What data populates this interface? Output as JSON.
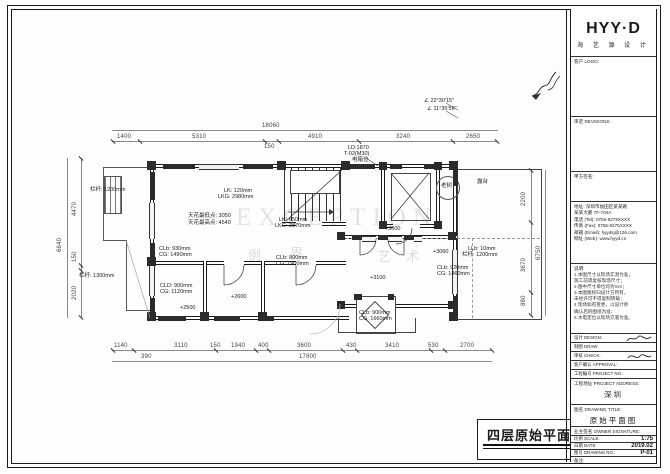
{
  "drawing_title": {
    "text": "四层原始平面图",
    "scale": "1:75"
  },
  "colors": {
    "line": "#1a1a1a",
    "wall_fill": "#2b2b2b",
    "dim": "#444",
    "paper": "#ffffff"
  },
  "title_block": {
    "logo": "HYY·D",
    "logo_sub": "海 艺 源 设 计",
    "client_logo_label": "客户 LOGO:",
    "revisions_label": "审定 REVISIONS:",
    "sign_label": "甲方签名:",
    "contact": {
      "addr1": "地址: 深圳市福田区某某路",
      "addr2": "某某大厦 7F-704A",
      "tel": "电话 (Tel): 0755-8279XXXX",
      "fax": "传真 (Fax): 0755-8275XXXX",
      "email": "邮箱 (Email): hyydsj@126.com",
      "web": "网址 (Web): www.hyyd.cn"
    },
    "notes_label": "说明:",
    "notes": [
      "1.本图尺寸以现场实测为准，",
      "施工前须复核现场尺寸；",
      "2.图中尺寸单位均为mm；",
      "3.本图版权归设计方所有，",
      "未经许可不得复制转载；",
      "4.现场如有变更，以设计师",
      "确认后的图纸为准；",
      "5.水电定位以现场交底为准。"
    ],
    "sig_rows": {
      "design": "设计 DESIGN:",
      "draw": "制图 DRAW:",
      "check": "审核 CHECK:",
      "approval": "客户确认 APPROVAL:",
      "project_no": "工程编号 PROJECT NO.:"
    },
    "address_label": "工程地址 PROJECT ADDRESS:",
    "address_value": "深圳",
    "title_label": "图名 DRAWING TITLE:",
    "title_value": "原始平面图",
    "owner_label": "业主签名 OWNER SIGNATURE:",
    "scale_label": "比例 SCALE:",
    "scale_value": "1:75",
    "date_label": "日期 DATE:",
    "date_value": "2019.02",
    "no_label": "图号 DRAWING NO.:",
    "no_value": "P-01",
    "remark_label": "备注:"
  },
  "plan": {
    "annotations": [
      {
        "t": "18060",
        "x": 262,
        "y": 123,
        "c": "dim"
      },
      {
        "t": "1400",
        "x": 117,
        "y": 134,
        "c": "dim"
      },
      {
        "t": "5310",
        "x": 192,
        "y": 134,
        "c": "dim"
      },
      {
        "t": "150",
        "x": 264,
        "y": 144,
        "c": "dim"
      },
      {
        "t": "4910",
        "x": 308,
        "y": 134,
        "c": "dim"
      },
      {
        "t": "3240",
        "x": 396,
        "y": 134,
        "c": "dim"
      },
      {
        "t": "2650",
        "x": 466,
        "y": 134,
        "c": "dim"
      },
      {
        "t": "1140",
        "x": 114,
        "y": 343,
        "c": "dim"
      },
      {
        "t": "3110",
        "x": 174,
        "y": 343,
        "c": "dim"
      },
      {
        "t": "150",
        "x": 210,
        "y": 343,
        "c": "dim"
      },
      {
        "t": "1940",
        "x": 231,
        "y": 343,
        "c": "dim"
      },
      {
        "t": "400",
        "x": 258,
        "y": 343,
        "c": "dim"
      },
      {
        "t": "3600",
        "x": 297,
        "y": 343,
        "c": "dim"
      },
      {
        "t": "430",
        "x": 346,
        "y": 343,
        "c": "dim"
      },
      {
        "t": "3410",
        "x": 385,
        "y": 343,
        "c": "dim"
      },
      {
        "t": "530",
        "x": 428,
        "y": 343,
        "c": "dim"
      },
      {
        "t": "2700",
        "x": 460,
        "y": 343,
        "c": "dim"
      },
      {
        "t": "390",
        "x": 141,
        "y": 354,
        "c": "dim"
      },
      {
        "t": "17800",
        "x": 299,
        "y": 354,
        "c": "dim"
      },
      {
        "t": "6640",
        "x": 57,
        "y": 252,
        "c": "dimv"
      },
      {
        "t": "4470",
        "x": 72,
        "y": 216,
        "c": "dimv"
      },
      {
        "t": "150",
        "x": 72,
        "y": 262,
        "c": "dimv"
      },
      {
        "t": "2020",
        "x": 72,
        "y": 300,
        "c": "dimv"
      },
      {
        "t": "6750",
        "x": 536,
        "y": 260,
        "c": "dimv"
      },
      {
        "t": "2200",
        "x": 521,
        "y": 206,
        "c": "dimv"
      },
      {
        "t": "3670",
        "x": 521,
        "y": 272,
        "c": "dimv"
      },
      {
        "t": "880",
        "x": 521,
        "y": 306,
        "c": "dimv"
      },
      {
        "t": "天花最低点: 3050",
        "x": 188,
        "y": 213,
        "c": "ann"
      },
      {
        "t": "天花最高点: 4540",
        "x": 188,
        "y": 220,
        "c": "ann"
      },
      {
        "t": "LK: 120mm",
        "x": 224,
        "y": 188,
        "c": "ann"
      },
      {
        "t": "LKG: 2980mm",
        "x": 218,
        "y": 194,
        "c": "ann"
      },
      {
        "t": "LK: 650mm",
        "x": 279,
        "y": 217,
        "c": "ann"
      },
      {
        "t": "LKG: 2870mm",
        "x": 275,
        "y": 223,
        "c": "ann"
      },
      {
        "t": "CLb: 930mm",
        "x": 159,
        "y": 246,
        "c": "ann"
      },
      {
        "t": "CG: 1490mm",
        "x": 159,
        "y": 252,
        "c": "ann"
      },
      {
        "t": "CLb: 800mm",
        "x": 276,
        "y": 255,
        "c": "ann"
      },
      {
        "t": "CG: 1900mm",
        "x": 276,
        "y": 261,
        "c": "ann"
      },
      {
        "t": "CLD: 900mm",
        "x": 160,
        "y": 283,
        "c": "ann"
      },
      {
        "t": "CG: 1120mm",
        "x": 160,
        "y": 289,
        "c": "ann"
      },
      {
        "t": "+2600",
        "x": 231,
        "y": 294,
        "c": "ann"
      },
      {
        "t": "+2500",
        "x": 180,
        "y": 305,
        "c": "ann"
      },
      {
        "t": "+3000",
        "x": 385,
        "y": 226,
        "c": "ann"
      },
      {
        "t": "+3100",
        "x": 370,
        "y": 275,
        "c": "ann"
      },
      {
        "t": "+3060",
        "x": 433,
        "y": 249,
        "c": "ann"
      },
      {
        "t": "CLb: 920mm",
        "x": 437,
        "y": 265,
        "c": "ann"
      },
      {
        "t": "CG: 1460mm",
        "x": 437,
        "y": 271,
        "c": "ann"
      },
      {
        "t": "LLb: 10mm",
        "x": 468,
        "y": 246,
        "c": "ann"
      },
      {
        "t": "栏杆: 1200mm",
        "x": 462,
        "y": 252,
        "c": "ann"
      },
      {
        "t": "CLb: 900mm",
        "x": 359,
        "y": 310,
        "c": "ann"
      },
      {
        "t": "CG: 1660mm",
        "x": 359,
        "y": 316,
        "c": "ann"
      },
      {
        "t": "栏杆: 1200mm",
        "x": 90,
        "y": 187,
        "c": "ann"
      },
      {
        "t": "栏杆: 1300mm",
        "x": 79,
        "y": 273,
        "c": "ann"
      },
      {
        "t": "LD:1870",
        "x": 348,
        "y": 145,
        "c": "ann"
      },
      {
        "t": "T-02(M30)",
        "x": 344,
        "y": 151,
        "c": "ann"
      },
      {
        "t": "电箱位",
        "x": 352,
        "y": 157,
        "c": "ann"
      },
      {
        "t": "∠ 22°30'15\"",
        "x": 424,
        "y": 98,
        "c": "ann"
      },
      {
        "t": "∠ 11°35'56\"",
        "x": 427,
        "y": 106,
        "c": "ann"
      },
      {
        "t": "老树",
        "x": 441,
        "y": 183,
        "c": "ann"
      },
      {
        "t": "露台",
        "x": 477,
        "y": 179,
        "c": "ann"
      },
      {
        "t": "EXCEPTION",
        "x": 236,
        "y": 204,
        "c": "wm"
      },
      {
        "t": "例",
        "x": 248,
        "y": 245,
        "c": "wmc"
      },
      {
        "t": "界",
        "x": 290,
        "y": 243,
        "c": "wmc"
      },
      {
        "t": "艺",
        "x": 378,
        "y": 246,
        "c": "wmc"
      },
      {
        "t": "术",
        "x": 406,
        "y": 246,
        "c": "wmc"
      }
    ]
  }
}
